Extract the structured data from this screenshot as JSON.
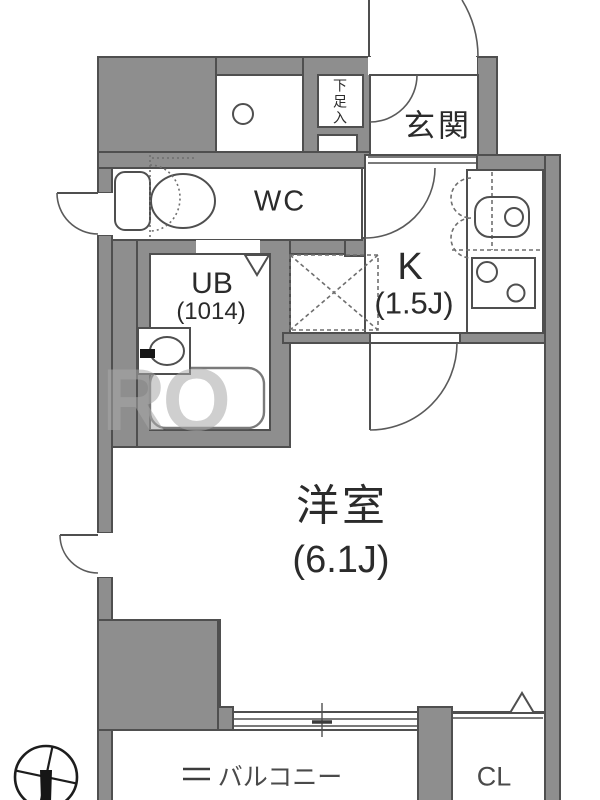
{
  "plan": {
    "type": "apartment-floor-plan",
    "rooms": {
      "genkan": {
        "label": "玄関"
      },
      "wc": {
        "label": "WC"
      },
      "unit_bath": {
        "label": "UB",
        "size": "(1014)"
      },
      "kitchen": {
        "label": "K",
        "size": "(1.5J)"
      },
      "main_room": {
        "label": "洋室",
        "size": "(6.1J)"
      },
      "balcony": {
        "label": "バルコニー"
      },
      "closet": {
        "label": "CL"
      },
      "shoe_storage": {
        "label": "下足入"
      }
    },
    "watermark": "RO",
    "colors": {
      "wall": "#8e8e8e",
      "outline": "#4f4f4f",
      "floor": "#ffffff",
      "text": "#2b2b2b"
    }
  }
}
